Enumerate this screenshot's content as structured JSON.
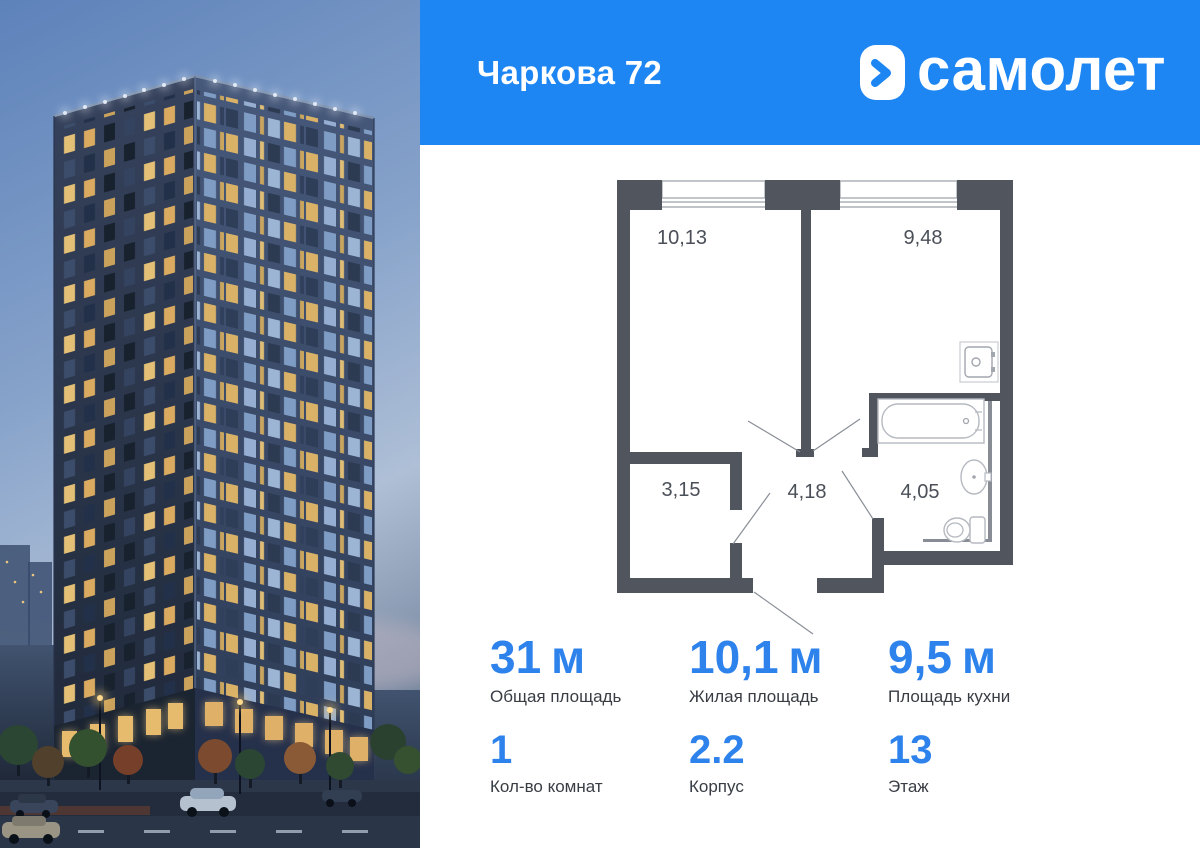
{
  "header": {
    "title": "Чаркова 72",
    "brand": "самолет"
  },
  "colors": {
    "header_blue": "#1d86f3",
    "stat_blue": "#2d82ec",
    "plan_wall": "#51555e"
  },
  "floor_plan": {
    "rooms": [
      {
        "id": "room-left",
        "area": "10,13"
      },
      {
        "id": "room-right",
        "area": "9,48"
      },
      {
        "id": "closet",
        "area": "3,15"
      },
      {
        "id": "hallway",
        "area": "4,18"
      },
      {
        "id": "bathroom",
        "area": "4,05"
      }
    ]
  },
  "stats": {
    "row1": [
      {
        "value": "31",
        "unit": "м",
        "label": "Общая площадь"
      },
      {
        "value": "10,1",
        "unit": "м",
        "label": "Жилая площадь"
      },
      {
        "value": "9,5",
        "unit": "м",
        "label": "Площадь кухни"
      }
    ],
    "row2": [
      {
        "value": "1",
        "label": "Кол-во комнат"
      },
      {
        "value": "2.2",
        "label": "Корпус"
      },
      {
        "value": "13",
        "label": "Этаж"
      }
    ]
  }
}
